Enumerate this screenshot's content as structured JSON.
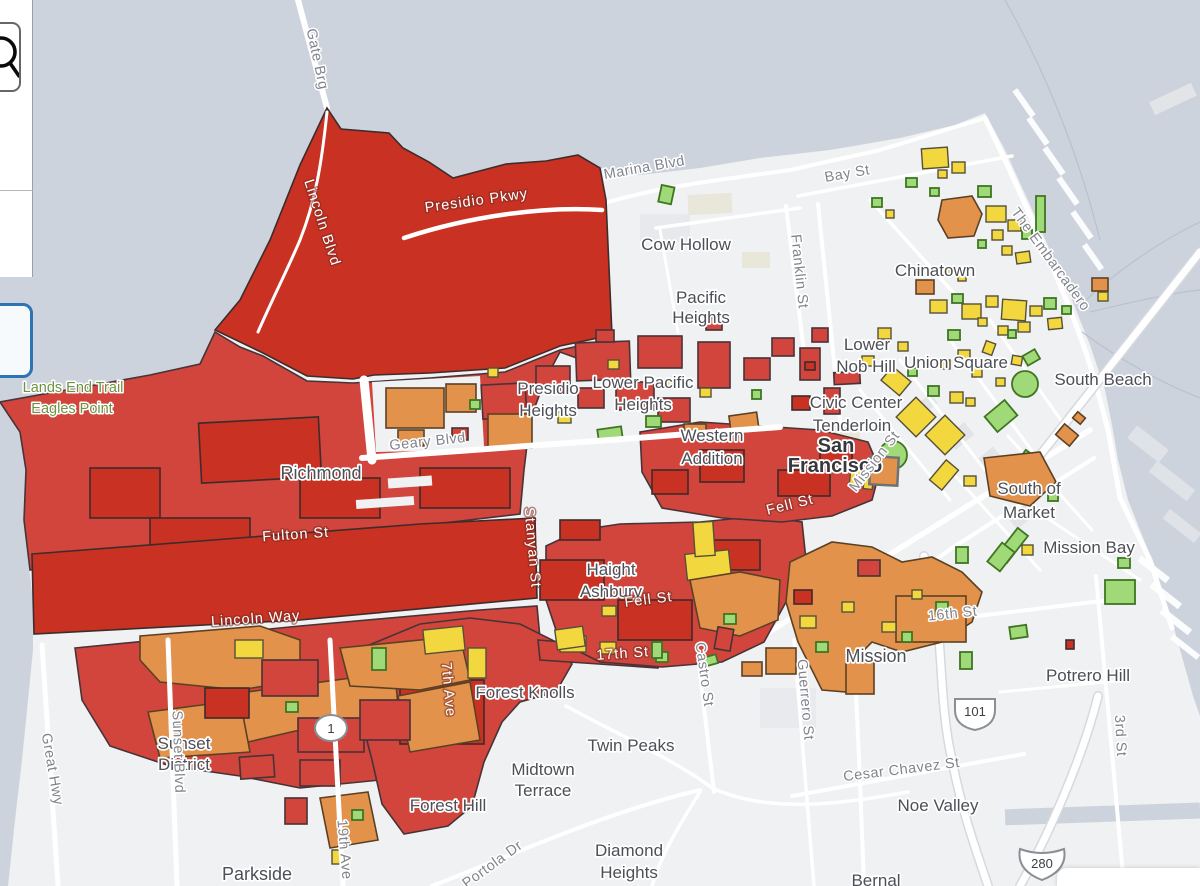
{
  "ui": {
    "sidebar": {
      "search_button_icon": "magnifier"
    },
    "active_tool_button": {
      "state": "selected"
    }
  },
  "map": {
    "colors": {
      "red": "#d1453c",
      "darkred": "#c93122",
      "orange": "#e3924c",
      "yellow": "#f2d73e",
      "green": "#a0d977",
      "greenline": "#3f7522",
      "water": "#cdd3dd",
      "land": "#eff1f2"
    },
    "labels": {
      "gate_brg": {
        "text": "Gate Brg"
      },
      "lincoln_blvd": {
        "text": "Lincoln Blvd"
      },
      "presidio_pkwy": {
        "text": "Presidio Pkwy"
      },
      "marina_blvd": {
        "text": "Marina Blvd"
      },
      "cow_hollow": {
        "text": "Cow Hollow"
      },
      "bay_st": {
        "text": "Bay St"
      },
      "franklin_st": {
        "text": "Franklin St"
      },
      "chinatown": {
        "text": "Chinatown"
      },
      "the_embarcadero": {
        "text": "The Embarcadero"
      },
      "pacific_heights": {
        "text": "Pacific Heights",
        "lines": [
          "Pacific",
          "Heights"
        ]
      },
      "lower_nob_hill": {
        "text": "Lower Nob Hill",
        "lines": [
          "Lower",
          "Nob Hill"
        ]
      },
      "union_square": {
        "text": "Union Square"
      },
      "south_beach": {
        "text": "South Beach"
      },
      "presidio_heights": {
        "text": "Presidio Heights",
        "lines": [
          "Presidio",
          "Heights"
        ]
      },
      "lower_pacific_heights": {
        "text": "Lower Pacific Heights",
        "lines": [
          "Lower Pacific",
          "Heights"
        ]
      },
      "civic_center": {
        "text": "Civic Center"
      },
      "tenderloin": {
        "text": "Tenderloin"
      },
      "san_francisco": {
        "text": "San Francisco",
        "lines": [
          "San",
          "Francisco"
        ]
      },
      "western_addition": {
        "text": "Western Addition",
        "lines": [
          "Western",
          "Addition"
        ]
      },
      "geary_blvd": {
        "text": "Geary Blvd"
      },
      "richmond": {
        "text": "Richmond"
      },
      "south_of_market": {
        "text": "South of Market",
        "lines": [
          "South of",
          "Market"
        ]
      },
      "mission_bay": {
        "text": "Mission Bay"
      },
      "mission_st": {
        "text": "Mission St"
      },
      "fell_st_upper": {
        "text": "Fell St"
      },
      "fell_st": {
        "text": "Fell St"
      },
      "fulton_st": {
        "text": "Fulton St"
      },
      "stanyan_st": {
        "text": "Stanyan St"
      },
      "haight_ashbury": {
        "text": "Haight Ashbury",
        "lines": [
          "Haight",
          "Ashbury"
        ]
      },
      "lincoln_way": {
        "text": "Lincoln Way"
      },
      "sixteenth_st": {
        "text": "16th St"
      },
      "mission": {
        "text": "Mission"
      },
      "seventeenth_st": {
        "text": "17th St"
      },
      "castro_st": {
        "text": "Castro St"
      },
      "potrero_hill": {
        "text": "Potrero Hill"
      },
      "guerrero_st": {
        "text": "Guerrero St"
      },
      "seventh_ave": {
        "text": "7th Ave"
      },
      "forest_knolls": {
        "text": "Forest Knolls"
      },
      "third_st": {
        "text": "3rd St"
      },
      "sunset_district": {
        "text": "Sunset District",
        "lines": [
          "Sunset",
          "District"
        ]
      },
      "twin_peaks": {
        "text": "Twin Peaks"
      },
      "great_hwy": {
        "text": "Great Hwy"
      },
      "sunset_blvd": {
        "text": "Sunset Blvd"
      },
      "midtown_terrace": {
        "text": "Midtown Terrace",
        "lines": [
          "Midtown",
          "Terrace"
        ]
      },
      "cesar_chavez_st": {
        "text": "Cesar Chavez St"
      },
      "forest_hill": {
        "text": "Forest Hill"
      },
      "noe_valley": {
        "text": "Noe Valley"
      },
      "nineteenth_ave": {
        "text": "19th Ave"
      },
      "portola_dr": {
        "text": "Portola Dr"
      },
      "diamond_heights": {
        "text": "Diamond Heights",
        "lines": [
          "Diamond",
          "Heights"
        ]
      },
      "parkside": {
        "text": "Parkside"
      },
      "bernal": {
        "text": "Bernal"
      },
      "lands_end_trail": {
        "text": "Lands End Trail"
      },
      "eagles_point": {
        "text": "Eagles Point"
      },
      "shield_1": {
        "text": "1"
      },
      "shield_101": {
        "text": "101"
      },
      "shield_280": {
        "text": "280"
      }
    }
  }
}
